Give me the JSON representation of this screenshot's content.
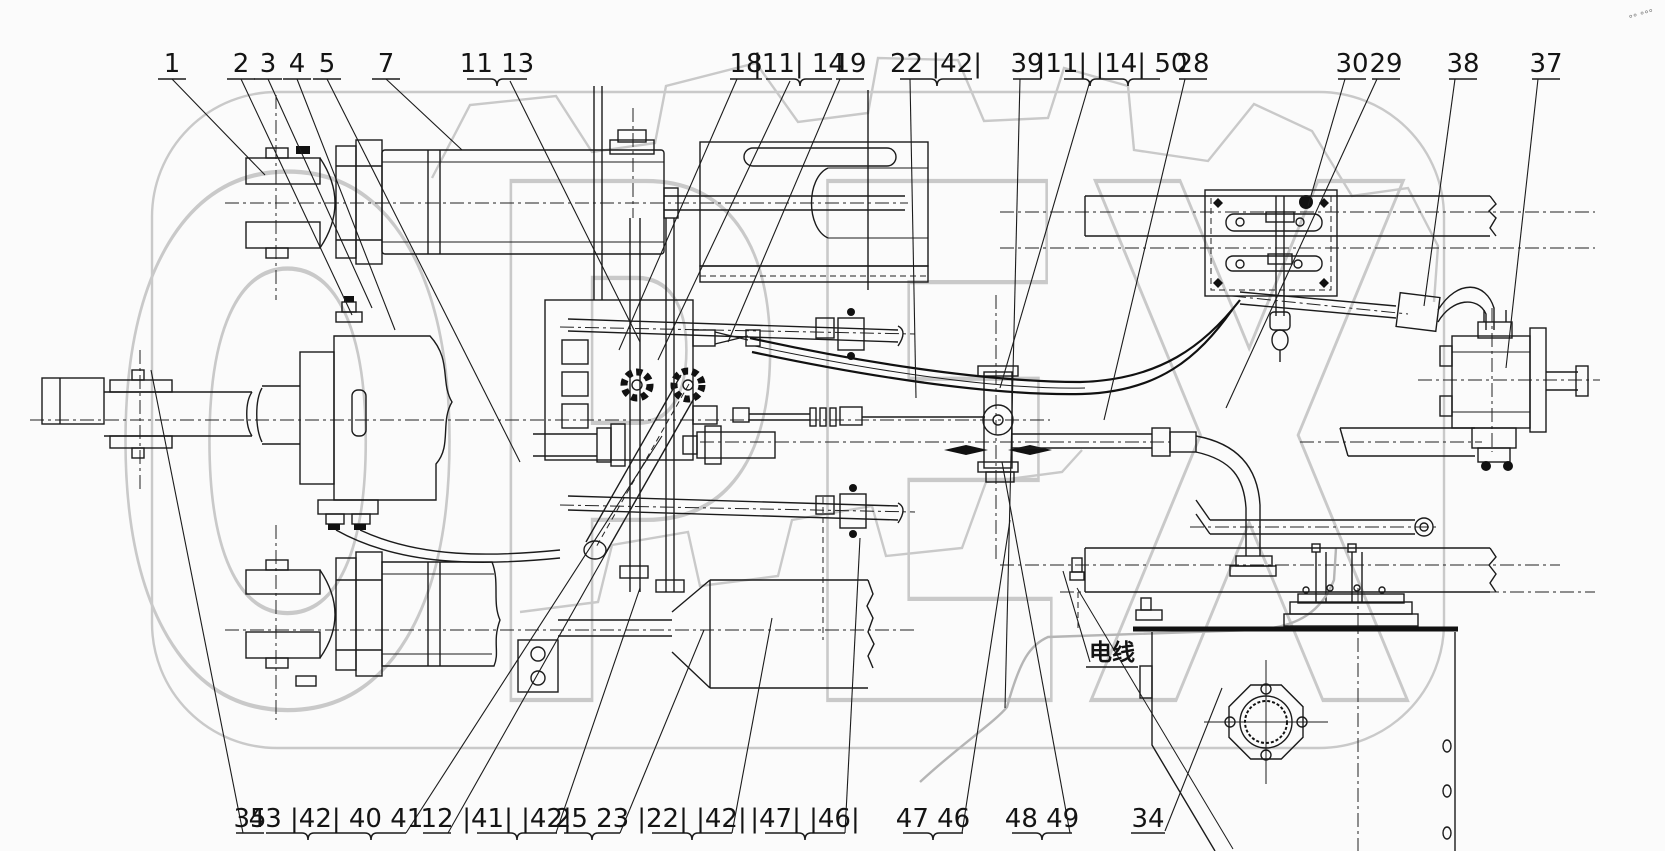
{
  "drawing": {
    "kind": "technical-assembly-line-drawing",
    "description": "Hydraulic steering system assembly with numbered part callouts, twin hydraulic cylinders, central valve manifold, hose runs, mounting plate, gear pump and oil tank"
  },
  "colors": {
    "line": "#1b1b1b",
    "watermark": "#c9c9c9",
    "background": "#fbfbfb"
  },
  "watermark": {
    "text": "OPEX"
  },
  "annotations": {
    "wire_label": "电线",
    "corner_marks": "°° °°°"
  },
  "callouts": {
    "top": [
      "1",
      "2",
      "3",
      "4",
      "5",
      "7",
      "11 13",
      "18",
      "|11| 14",
      "19",
      "22 |42|",
      "39",
      "|11| |14| 50",
      "28",
      "30",
      "29",
      "38",
      "37"
    ],
    "bottom": [
      "35",
      "43 |42| 40 41",
      "12",
      "|41| |42|",
      "25 23",
      "|22| |42|",
      "|47| |46|",
      "47 46",
      "48 49",
      "34"
    ]
  }
}
